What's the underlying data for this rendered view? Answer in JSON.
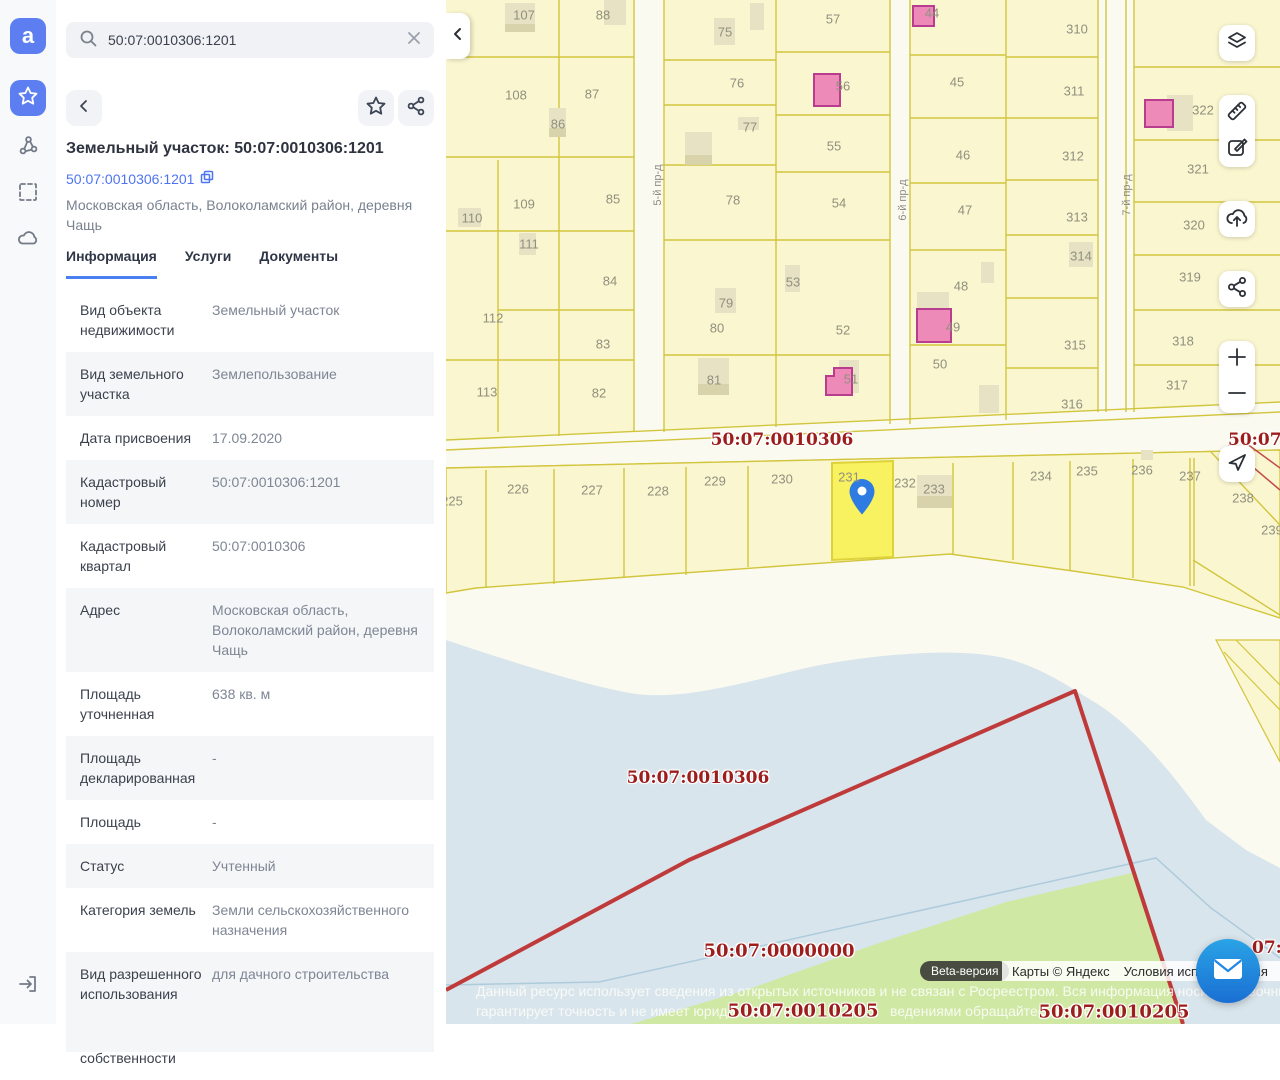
{
  "sidebar": {
    "logo_letter": "a",
    "icons": [
      "favorites-star",
      "layers-network",
      "area-select",
      "cloud",
      "exit"
    ]
  },
  "search": {
    "query": "50:07:0010306:1201"
  },
  "panel": {
    "title": "Земельный участок: 50:07:0010306:1201",
    "link": "50:07:0010306:1201",
    "address": "Московская область, Волоколамский район, деревня Чащь",
    "tabs": [
      {
        "label": "Информация",
        "active": true
      },
      {
        "label": "Услуги",
        "active": false
      },
      {
        "label": "Документы",
        "active": false
      }
    ],
    "info_rows": [
      {
        "label": "Вид объекта недвижимости",
        "value": "Земельный участок"
      },
      {
        "label": "Вид земельного участка",
        "value": "Землепользование"
      },
      {
        "label": "Дата присвоения",
        "value": "17.09.2020"
      },
      {
        "label": "Кадастровый номер",
        "value": "50:07:0010306:1201"
      },
      {
        "label": "Кадастровый квартал",
        "value": "50:07:0010306"
      },
      {
        "label": "Адрес",
        "value": "Московская область, Волоколамский район, деревня Чащь"
      },
      {
        "label": "Площадь уточненная",
        "value": "638 кв. м"
      },
      {
        "label": "Площадь декларированная",
        "value": "-"
      },
      {
        "label": "Площадь",
        "value": "-"
      },
      {
        "label": "Статус",
        "value": "Учтенный"
      },
      {
        "label": "Категория земель",
        "value": "Земли сельскохозяйственного назначения"
      },
      {
        "label": "Вид разрешенного использования",
        "value": "для дачного строительства"
      },
      {
        "label": "Форма собственности",
        "value": "Частная"
      }
    ]
  },
  "map": {
    "colors": {
      "parcel_fill": "#faf6cf",
      "selected_fill": "#f8f160",
      "grid": "#d2c53e",
      "water": "#d9e5ec",
      "green": "#cfe8a4",
      "pink_building": "#ee8ab8",
      "quarter_label": "#9d1d1d",
      "boundary_red": "#bf3a3a",
      "accent_blue": "#5d7ef0"
    },
    "selected_parcel": "231",
    "quarter_labels": [
      {
        "text": "50:07:0010306",
        "x": 336,
        "y": 440,
        "size": 17,
        "anchor": "center"
      },
      {
        "text": "50:07:",
        "x": 782,
        "y": 440,
        "size": 17,
        "anchor": "left"
      },
      {
        "text": "50:07:0010306",
        "x": 252,
        "y": 778,
        "size": 17,
        "anchor": "center"
      },
      {
        "text": "50:07:0000000",
        "x": 333,
        "y": 951,
        "size": 18,
        "anchor": "center"
      },
      {
        "text": "50:07:0010205",
        "x": 357,
        "y": 1011,
        "size": 18,
        "anchor": "center"
      },
      {
        "text": "50:07:0010205",
        "x": 668,
        "y": 1012,
        "size": 18,
        "anchor": "center"
      },
      {
        "text": "07:",
        "x": 806,
        "y": 948,
        "size": 17,
        "anchor": "left"
      }
    ],
    "road_labels": [
      {
        "text": "5-й пр-д",
        "x": 212,
        "y": 185
      },
      {
        "text": "6-й пр-д",
        "x": 457,
        "y": 200
      },
      {
        "text": "7-й пр-д",
        "x": 681,
        "y": 195
      }
    ],
    "parcels": [
      [
        "107",
        78,
        15
      ],
      [
        "88",
        157,
        15
      ],
      [
        "108",
        70,
        95
      ],
      [
        "87",
        146,
        94
      ],
      [
        "86",
        112,
        124
      ],
      [
        "109",
        78,
        204
      ],
      [
        "110",
        26,
        218
      ],
      [
        "85",
        167,
        199
      ],
      [
        "111",
        83,
        244
      ],
      [
        "84",
        164,
        281
      ],
      [
        "112",
        47,
        318
      ],
      [
        "83",
        157,
        344
      ],
      [
        "113",
        41,
        392
      ],
      [
        "82",
        153,
        393
      ],
      [
        "75",
        279,
        32
      ],
      [
        "57",
        387,
        19
      ],
      [
        "76",
        291,
        83
      ],
      [
        "56",
        397,
        86
      ],
      [
        "77",
        304,
        127
      ],
      [
        "55",
        388,
        146
      ],
      [
        "78",
        287,
        200
      ],
      [
        "54",
        393,
        203
      ],
      [
        "79",
        280,
        303
      ],
      [
        "53",
        347,
        282
      ],
      [
        "80",
        271,
        328
      ],
      [
        "52",
        397,
        330
      ],
      [
        "81",
        268,
        380
      ],
      [
        "51",
        405,
        379
      ],
      [
        "44",
        486,
        13
      ],
      [
        "310",
        631,
        29
      ],
      [
        "45",
        511,
        82
      ],
      [
        "311",
        628,
        91
      ],
      [
        "46",
        517,
        155
      ],
      [
        "312",
        627,
        156
      ],
      [
        "47",
        519,
        210
      ],
      [
        "313",
        631,
        217
      ],
      [
        "314",
        635,
        256
      ],
      [
        "48",
        515,
        286
      ],
      [
        "49",
        507,
        327
      ],
      [
        "315",
        629,
        345
      ],
      [
        "50",
        494,
        364
      ],
      [
        "316",
        626,
        404
      ],
      [
        "322",
        757,
        110
      ],
      [
        "321",
        752,
        169
      ],
      [
        "320",
        748,
        225
      ],
      [
        "319",
        744,
        277
      ],
      [
        "318",
        737,
        341
      ],
      [
        "317",
        731,
        385
      ],
      [
        "225",
        6,
        501
      ],
      [
        "226",
        72,
        489
      ],
      [
        "227",
        146,
        490
      ],
      [
        "228",
        212,
        491
      ],
      [
        "229",
        269,
        481
      ],
      [
        "230",
        336,
        479
      ],
      [
        "231",
        403,
        477
      ],
      [
        "232",
        459,
        483
      ],
      [
        "233",
        488,
        489
      ],
      [
        "234",
        595,
        476
      ],
      [
        "235",
        641,
        471
      ],
      [
        "236",
        696,
        470
      ],
      [
        "237",
        744,
        476
      ],
      [
        "238",
        797,
        498
      ],
      [
        "239",
        826,
        530
      ]
    ],
    "attribution": {
      "beta": "Beta-версия",
      "copyright": "Карты © Яндекс",
      "terms": "Условия использования"
    },
    "disclaimer_line1": "Данный ресурс использует сведения из открытых источников и не связан с Росреестром. Вся информация носит справочный характер",
    "disclaimer_line2a": "гарантирует точность и не имеет юридической с",
    "disclaimer_line2b": "ведениями обращайтесь в Рос"
  }
}
